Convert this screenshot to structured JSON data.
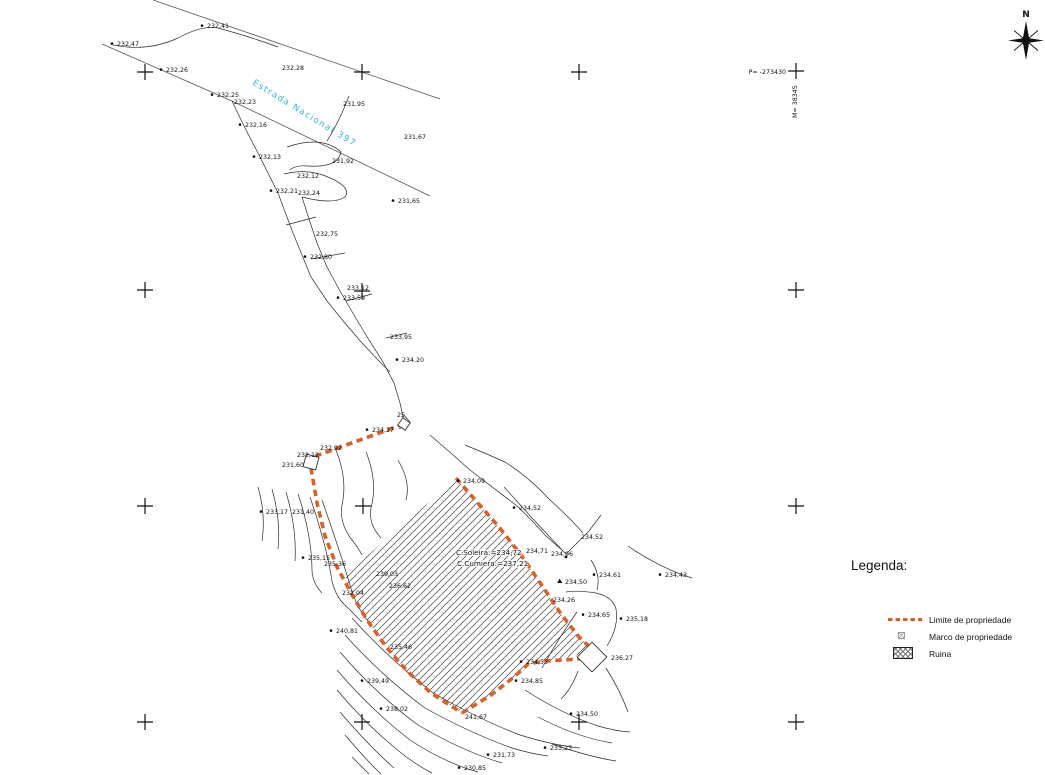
{
  "colors": {
    "boundary_orange": "#d4622c",
    "road_label_cyan": "#38b4d8",
    "line_black": "#1c1c1c"
  },
  "north_arrow": {
    "label": "N"
  },
  "coordinate_labels": {
    "p": "P= -273430",
    "m": "M= 38345"
  },
  "road": {
    "name": "Estrada Nacional 397"
  },
  "building": {
    "lines": [
      "C.Soleira:=234,72",
      "C.Cumiera:=237,21"
    ]
  },
  "legend": {
    "title": "Legenda:",
    "items": [
      {
        "id": "limite",
        "symbol": "dashed-orange-line",
        "label": "Limite de propriedade"
      },
      {
        "id": "marco",
        "symbol": "crossed-square",
        "label": "Marco de propriedade"
      },
      {
        "id": "ruina",
        "symbol": "diagonal-hatch",
        "label": "Ruina"
      }
    ]
  },
  "spot_elevations": [
    {
      "t": "232,41",
      "x": 207,
      "y": 28,
      "m": "dot"
    },
    {
      "t": "232,47",
      "x": 117,
      "y": 46,
      "m": "dot"
    },
    {
      "t": "232,26",
      "x": 166,
      "y": 72,
      "m": "dot"
    },
    {
      "t": "232,28",
      "x": 282,
      "y": 70,
      "m": null
    },
    {
      "t": "232,25",
      "x": 217,
      "y": 97,
      "m": "dot"
    },
    {
      "t": "232,23",
      "x": 234,
      "y": 104,
      "m": null
    },
    {
      "t": "231,95",
      "x": 343,
      "y": 106,
      "m": null
    },
    {
      "t": "232,16",
      "x": 245,
      "y": 127,
      "m": "dot"
    },
    {
      "t": "231,67",
      "x": 404,
      "y": 139,
      "m": null
    },
    {
      "t": "232,13",
      "x": 259,
      "y": 159,
      "m": "dot"
    },
    {
      "t": "231,92",
      "x": 332,
      "y": 163,
      "m": null
    },
    {
      "t": "232,12",
      "x": 297,
      "y": 178,
      "m": null
    },
    {
      "t": "232,21",
      "x": 276,
      "y": 193,
      "m": "dot"
    },
    {
      "t": "232,24",
      "x": 298,
      "y": 195,
      "m": null
    },
    {
      "t": "231,65",
      "x": 398,
      "y": 203,
      "m": "dot"
    },
    {
      "t": "232,75",
      "x": 316,
      "y": 236,
      "m": null
    },
    {
      "t": "232,80",
      "x": 310,
      "y": 259,
      "m": "dot"
    },
    {
      "t": "233,12",
      "x": 347,
      "y": 290,
      "m": null
    },
    {
      "t": "233,59",
      "x": 343,
      "y": 300,
      "m": "dot"
    },
    {
      "t": "233,95",
      "x": 390,
      "y": 339,
      "m": null
    },
    {
      "t": "234,20",
      "x": 402,
      "y": 362,
      "m": "dot"
    },
    {
      "t": "25",
      "x": 397,
      "y": 417,
      "m": null
    },
    {
      "t": "234,27",
      "x": 372,
      "y": 432,
      "m": "dot"
    },
    {
      "t": "232,92",
      "x": 320,
      "y": 450,
      "m": null
    },
    {
      "t": "232,12",
      "x": 297,
      "y": 457,
      "m": null
    },
    {
      "t": "231,60",
      "x": 282,
      "y": 467,
      "m": null
    },
    {
      "t": "233,17",
      "x": 266,
      "y": 514,
      "m": "dot"
    },
    {
      "t": "231,40",
      "x": 292,
      "y": 514,
      "m": null
    },
    {
      "t": "234,09",
      "x": 463,
      "y": 483,
      "m": "dot"
    },
    {
      "t": "234,52",
      "x": 519,
      "y": 510,
      "m": "dot"
    },
    {
      "t": "234,52",
      "x": 581,
      "y": 539,
      "m": null
    },
    {
      "t": "234,96",
      "x": 551,
      "y": 556,
      "m": null
    },
    {
      "t": "234,71",
      "x": 526,
      "y": 553,
      "m": null
    },
    {
      "t": "234,61",
      "x": 599,
      "y": 577,
      "m": "dot"
    },
    {
      "t": "234,43",
      "x": 665,
      "y": 577,
      "m": "dot"
    },
    {
      "t": "234,50",
      "x": 565,
      "y": 584,
      "m": "tri"
    },
    {
      "t": "234,26",
      "x": 553,
      "y": 602,
      "m": null
    },
    {
      "t": "234,65",
      "x": 588,
      "y": 617,
      "m": "dot"
    },
    {
      "t": "235,18",
      "x": 626,
      "y": 621,
      "m": "dot"
    },
    {
      "t": "235,15",
      "x": 308,
      "y": 560,
      "m": "dot"
    },
    {
      "t": "235,36",
      "x": 324,
      "y": 566,
      "m": null
    },
    {
      "t": "239,03",
      "x": 376,
      "y": 576,
      "m": null
    },
    {
      "t": "236,62",
      "x": 389,
      "y": 588,
      "m": null
    },
    {
      "t": "232,04",
      "x": 342,
      "y": 595,
      "m": null
    },
    {
      "t": "240,81",
      "x": 336,
      "y": 633,
      "m": "dot"
    },
    {
      "t": "235,46",
      "x": 390,
      "y": 649,
      "m": null
    },
    {
      "t": "239,49",
      "x": 367,
      "y": 683,
      "m": "dot"
    },
    {
      "t": "238,02",
      "x": 386,
      "y": 711,
      "m": "dot"
    },
    {
      "t": "241,67",
      "x": 465,
      "y": 719,
      "m": null
    },
    {
      "t": "234,53",
      "x": 526,
      "y": 664,
      "m": "dot"
    },
    {
      "t": "234,85",
      "x": 521,
      "y": 683,
      "m": "dot"
    },
    {
      "t": "236,27",
      "x": 611,
      "y": 660,
      "m": null
    },
    {
      "t": "234,50",
      "x": 576,
      "y": 716,
      "m": "dot"
    },
    {
      "t": "233,23",
      "x": 550,
      "y": 750,
      "m": "dot"
    },
    {
      "t": "231,73",
      "x": 493,
      "y": 757,
      "m": "dot"
    },
    {
      "t": "230,85",
      "x": 464,
      "y": 770,
      "m": "dot"
    }
  ],
  "map_geometry": {
    "crosses": [
      [
        145,
        72
      ],
      [
        362,
        72
      ],
      [
        579,
        72
      ],
      [
        796,
        71
      ],
      [
        145,
        290
      ],
      [
        362,
        291
      ],
      [
        796,
        290
      ],
      [
        145,
        506
      ],
      [
        363,
        506
      ],
      [
        796,
        506
      ],
      [
        145,
        722
      ],
      [
        362,
        722
      ],
      [
        579,
        722
      ],
      [
        796,
        722
      ]
    ],
    "road_edges": [
      "M153,0 L440,99",
      "M102,44 L232,101 L430,196"
    ],
    "thin_lines": [
      "M113,45 Q148,52 178,38 Q202,25 218,28 Q240,34 258,40 Q270,44 278,47",
      "M349,96 Q340,120 327,141",
      "M287,147 Q322,135 341,152 Q338,168 308,166 Q295,165 290,170",
      "M284,174 Q308,168 328,177 Q352,187 345,197 Q333,205 302,197",
      "M232,101 L244,126 L261,159 L278,193 L293,233 L311,277 L327,301 L344,322 L362,343 L380,362 L390,372",
      "M302,197 L309,219 L317,243 L327,267 L340,291 L354,315 L369,340 L383,362 L394,383 L400,403 L404,421",
      "M286,225 L316,217",
      "M311,259 L345,253",
      "M346,301 L372,294",
      "M386,338 L407,333",
      "M258,487 Q266,515 262,541",
      "M272,489 Q281,521 278,549",
      "M286,492 Q297,529 295,561",
      "M298,494 Q312,536 312,571 Q313,584 322,593",
      "M310,497 Q327,547 332,581 Q336,598 347,607 Q355,615 362,622",
      "M322,500 Q342,557 352,592 Q360,614 372,625",
      "M335,448 Q348,478 342,505 Q339,523 352,540 Q359,549 362,555",
      "M366,452 Q378,482 371,508 Q368,524 381,538",
      "M398,460 Q411,482 406,500",
      "M430,435 Q450,452 470,470 L517,506 Q532,520 545,535 L563,551",
      "M465,445 Q485,453 505,462 Q530,478 550,500 Q570,518 583,533",
      "M504,487 L533,519 L562,550 L566,554 L589,531 L601,515",
      "M628,546 Q660,568 692,578",
      "M591,560 Q601,575 597,590",
      "M607,646 Q619,627 616,609 Q613,597 596,593 Q577,590 566,592",
      "M542,668 Q560,636 577,612",
      "M606,668 Q620,690 628,712",
      "M578,671 Q572,688 561,699",
      "M352,618 Q390,660 432,692 Q478,719 520,735 Q552,745 580,748",
      "M345,635 Q383,677 425,708 Q470,733 512,748 Q532,754 548,756",
      "M340,652 Q376,694 418,725 Q462,751 502,763",
      "M337,670 Q371,710 410,740 Q445,763 478,772",
      "M337,690 Q369,728 405,756 Q420,767 432,773",
      "M340,712 Q369,746 394,768",
      "M345,735 Q369,763 381,774",
      "M352,757 L369,774",
      "M525,690 Q562,714 598,726 Q615,731 630,732",
      "M538,717 Q576,737 612,743",
      "M552,744 Q590,757 616,761",
      "M404,415 L410,422 L399,429"
    ],
    "boundary": [
      "M404,424 L313,457",
      "M311,468 L317,503 L325,536 L337,567 L351,593 L367,620 L387,648 L407,671 L431,693 L462,713",
      "M462,713 L491,695 L514,677 L528,664 L545,661 L596,658",
      "M456,478 L477,502 L499,527 L521,555 L543,587 L561,614 L579,637 L594,651"
    ],
    "hatch_points": "456,479 477,502 499,527 521,555 543,587 561,614 579,637 594,651 570,657 545,661 528,664 514,677 491,695 462,713 431,693 407,671 387,648 367,620 351,593 345,575",
    "marcos": [
      {
        "x": 311,
        "y": 462,
        "s": 13,
        "r": 15
      },
      {
        "x": 592,
        "y": 657,
        "s": 21,
        "r": 45
      },
      {
        "x": 404,
        "y": 424,
        "s": 9,
        "r": 35
      }
    ],
    "points": [
      [
        566,
        557
      ]
    ],
    "building_labels": [
      {
        "x": 456,
        "y": 555
      },
      {
        "x": 457,
        "y": 566
      }
    ],
    "road_label": {
      "x": 252,
      "y": 84,
      "angle": 31.5
    },
    "p_label": {
      "x": 786,
      "y": 74
    },
    "m_label": {
      "x": 797,
      "y": 118
    },
    "north": {
      "paths": [
        "M1026,21 L1029.5,40.5 L1026,60 L1022.5,40.5 Z",
        "M1008,40.5 L1026,37.8 L1044,40.5 L1026,43.2 Z"
      ],
      "lines": "M1026,40.5 L1014,30.5 M1026,40.5 L1038,30.5 M1026,40.5 L1014,50.5 M1026,40.5 L1038,50.5",
      "label_x": 1026,
      "label_y": 17
    }
  }
}
